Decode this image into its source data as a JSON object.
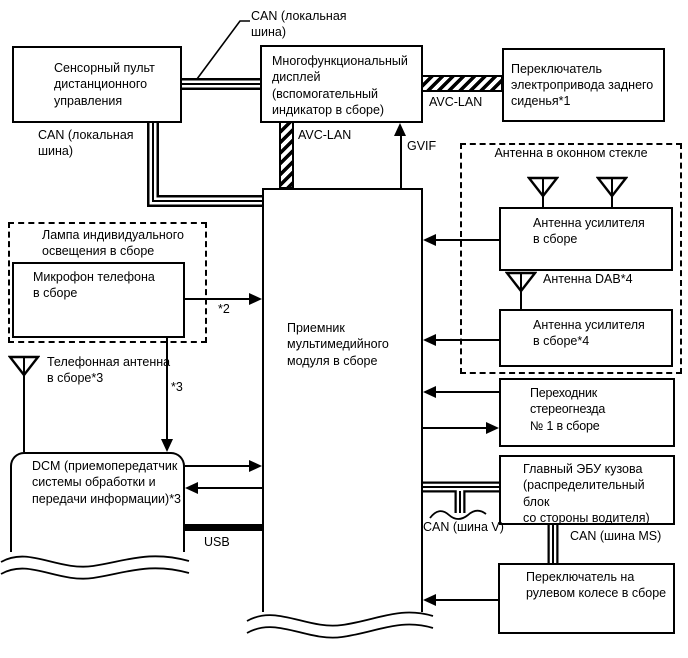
{
  "diagram": {
    "background_color": "#ffffff",
    "line_color": "#000000",
    "nodes": {
      "sensor_remote": {
        "label": "Сенсорный пульт\nдистанционного\nуправления"
      },
      "multifunction_display": {
        "label": "Многофункциональный\nдисплей (вспомогательный\nиндикатор в сборе)"
      },
      "rear_seat_switch": {
        "label": "Переключатель\nэлектропривода заднего\nсиденья*1"
      },
      "multimedia_receiver": {
        "label": "Приемник\nмультимедийного\nмодуля в сборе"
      },
      "lamp_assembly_group": {
        "label": "Лампа индивидуального\nосвещения в сборе"
      },
      "phone_microphone": {
        "label": "Микрофон телефона\nв сборе"
      },
      "phone_antenna": {
        "label": "Телефонная антенна\nв сборе*3"
      },
      "dcm": {
        "label": "DCM (приемопередатчик\nсистемы обработки и\nпередачи информации)*3"
      },
      "window_glass_antenna_group": {
        "label": "Антенна в оконном стекле"
      },
      "antenna_amplifier_1": {
        "label": "Антенна усилителя\nв сборе"
      },
      "dab_antenna": {
        "label": "Антенна DAB*4"
      },
      "antenna_amplifier_2": {
        "label": "Антенна усилителя\nв сборе*4"
      },
      "stereo_jack_adapter": {
        "label": "Переходник стереогнезда\n№ 1 в сборе"
      },
      "main_body_ecu": {
        "label": "Главный ЭБУ кузова\n(распределительный блок\nсо стороны водителя)"
      },
      "steering_pad_switch": {
        "label": "Переключатель на\nрулевом колесе в сборе"
      }
    },
    "bus_labels": {
      "can_local_top": "CAN (локальная\nшина)",
      "can_local_left": "CAN (локальная\nшина)",
      "avc_lan_horizontal": "AVC-LAN",
      "avc_lan_vertical": "AVC-LAN",
      "gvif": "GVIF",
      "usb": "USB",
      "can_bus_v": "CAN (шина V)",
      "can_bus_ms": "CAN (шина MS)",
      "footnote_2": "*2",
      "footnote_3": "*3"
    }
  }
}
